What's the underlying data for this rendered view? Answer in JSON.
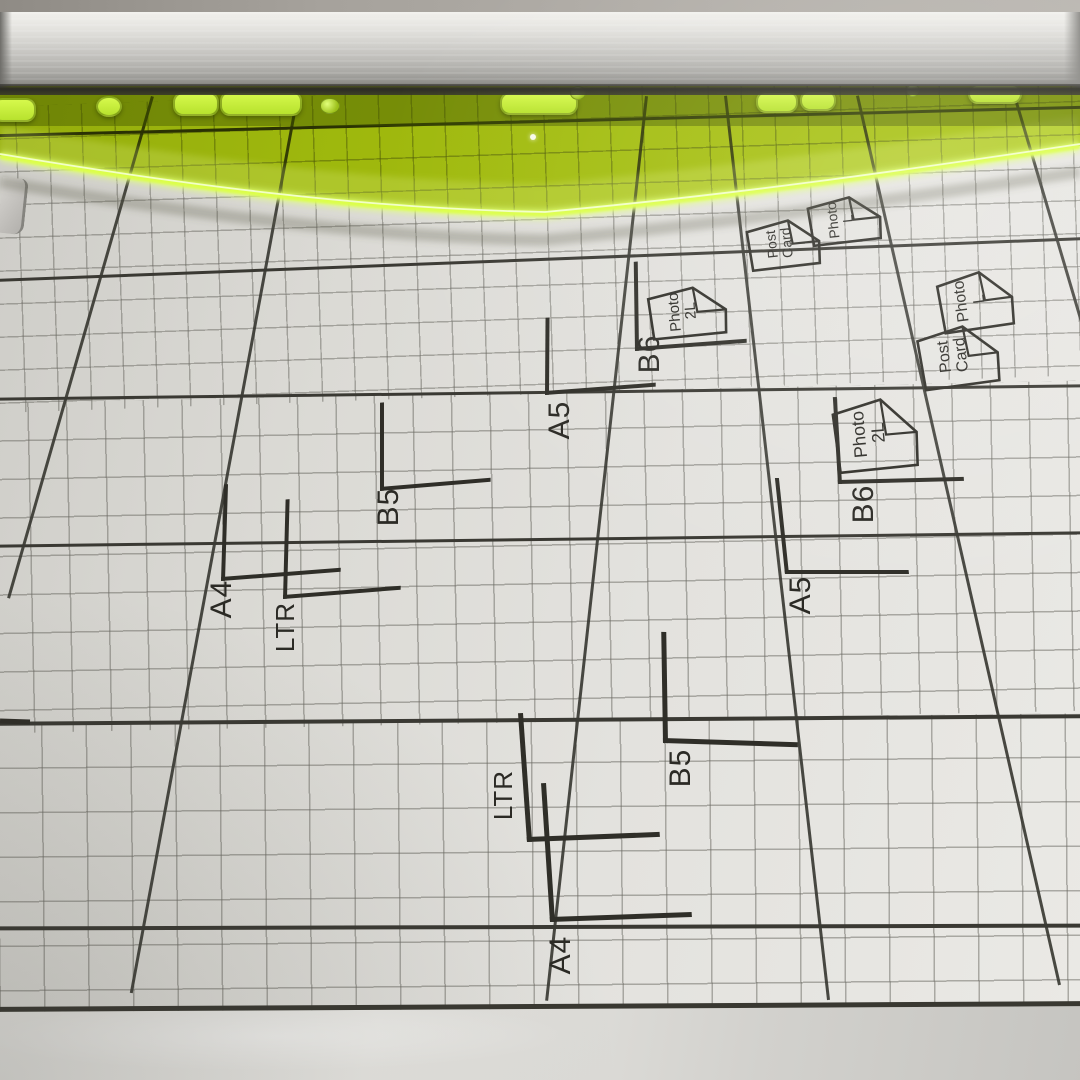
{
  "subject": {
    "description": "Photograph of a paper trimmer cutting board with printed size grid, neon green safety guard and aluminum rail"
  },
  "colors": {
    "board_surface": "#e0dfdb",
    "ink": "#2f2e28",
    "grid_major": "#3a3933",
    "grid_minor": "#6a6962",
    "guard_green": "#b5d600",
    "guard_edge_glow": "#dcff4a",
    "rail_silver": "#d3d2ce"
  },
  "size_marks": [
    {
      "label": "B6"
    },
    {
      "label": "A5"
    },
    {
      "label": "B5"
    },
    {
      "label": "A4"
    },
    {
      "label": "LTR"
    },
    {
      "label": "B6"
    },
    {
      "label": "A5"
    },
    {
      "label": "B5"
    },
    {
      "label": "LTR"
    },
    {
      "label": "A4"
    }
  ],
  "paper_icons": [
    {
      "line1": "Post",
      "line2": "Card"
    },
    {
      "line1": "Photo",
      "line2": "L"
    },
    {
      "line1": "Photo",
      "line2": "L"
    },
    {
      "line1": "Post",
      "line2": "Card"
    },
    {
      "line1": "Photo",
      "line2": "2L"
    },
    {
      "line1": "Photo",
      "line2": "2L"
    }
  ]
}
